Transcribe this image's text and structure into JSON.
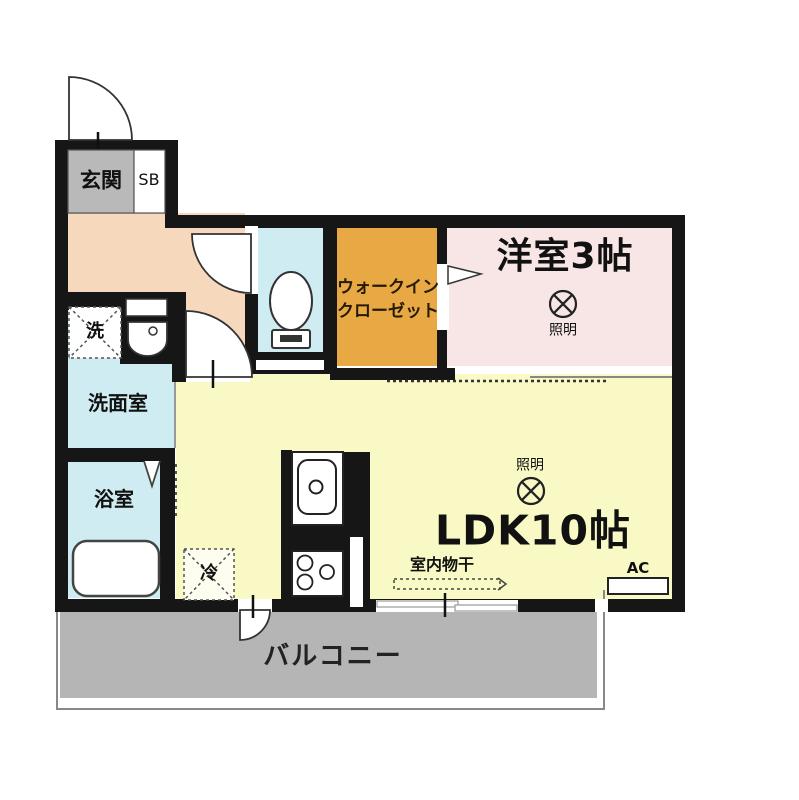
{
  "plan_title": "1LDK floor plan",
  "colors": {
    "wall": "#161616",
    "hallway": "#f6d9bc",
    "genkan_gray": "#b9b9b9",
    "water_rooms_blue": "#cfecf2",
    "closet_orange": "#e8a844",
    "western_room_pink": "#f8e6e6",
    "ldk_yellow": "#f9f9c5",
    "balcony_gray": "#b5b5b5"
  },
  "rooms": {
    "genkan": {
      "label": "玄関"
    },
    "shoe_box": {
      "label": "SB"
    },
    "closet": {
      "label_line1": "ウォークイン",
      "label_line2": "クローゼット"
    },
    "western_room": {
      "label": "洋室3帖",
      "light_label": "照明"
    },
    "washroom": {
      "label": "洗面室",
      "washer_label": "洗"
    },
    "bathroom": {
      "label": "浴室"
    },
    "ldk": {
      "label": "LDK10帖",
      "light_label": "照明",
      "drying_label": "室内物干",
      "ac_label": "AC",
      "fridge_label": "冷"
    },
    "balcony": {
      "label": "バルコニー"
    }
  }
}
